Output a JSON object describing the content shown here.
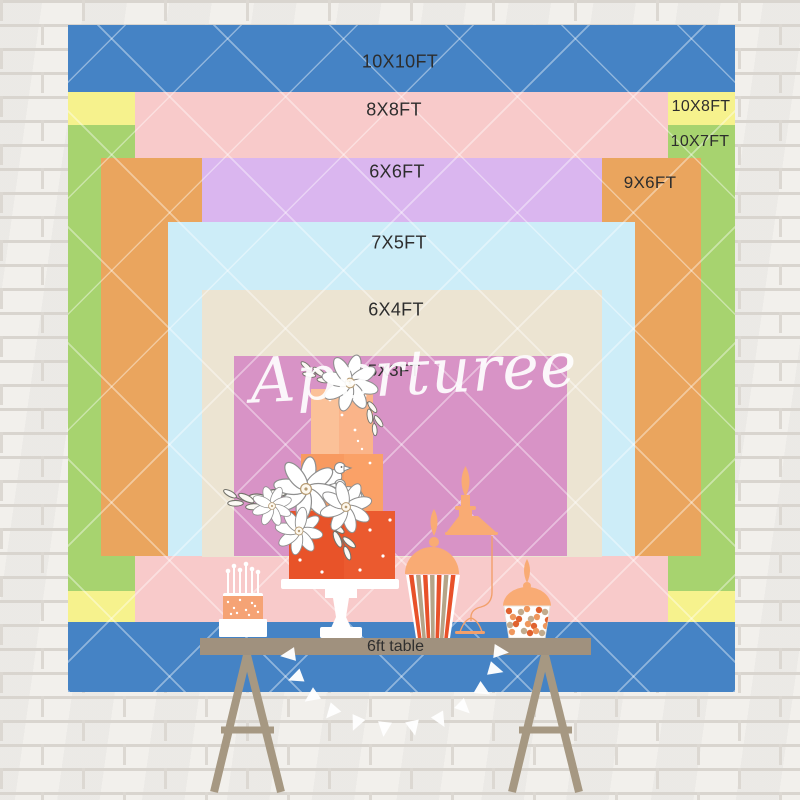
{
  "watermark": {
    "text": "Aperturee"
  },
  "sizes": [
    {
      "label": "10X10FT",
      "color": "#4583c5"
    },
    {
      "label": "8X8FT",
      "color": "#f8caca"
    },
    {
      "label": "10X8FT",
      "color": "#f6f28d"
    },
    {
      "label": "10X7FT",
      "color": "#a7d36f"
    },
    {
      "label": "6X6FT",
      "color": "#dab6ef"
    },
    {
      "label": "9X6FT",
      "color": "#eaa55e"
    },
    {
      "label": "7X5FT",
      "color": "#cdedf8"
    },
    {
      "label": "6X4FT",
      "color": "#ece4d2"
    },
    {
      "label": "5X3FT",
      "color": "#d893c6"
    }
  ],
  "table": {
    "label": "6ft table"
  },
  "palette": {
    "wall": "#f1efeb",
    "mortar": "#dcd8d2",
    "label_text": "#2d2d2d",
    "table_bar": "#a0917e",
    "trestle_legs": "#a69882",
    "cake_top_tier": "#fab489",
    "cake_middle_tier": "#f89a60",
    "cake_bottom_tier": "#e85329",
    "jar_silhouette": "#f9ab74",
    "popcorn_stripe_red": "#e8512a",
    "popcorn_stripe_tan": "#b5a488",
    "candle_cake": "#f5a375",
    "bunting": "#ffffff",
    "watermark": "#ffffff"
  },
  "illustrations": [
    "three-tier-cake-illustration",
    "daisy-flower-illustration",
    "bird-illustration",
    "candle-cake-illustration",
    "apothecary-jar-illustration",
    "popcorn-cup-illustration",
    "candy-bowl-illustration",
    "pennant-garland-illustration",
    "trestle-table-illustration"
  ]
}
